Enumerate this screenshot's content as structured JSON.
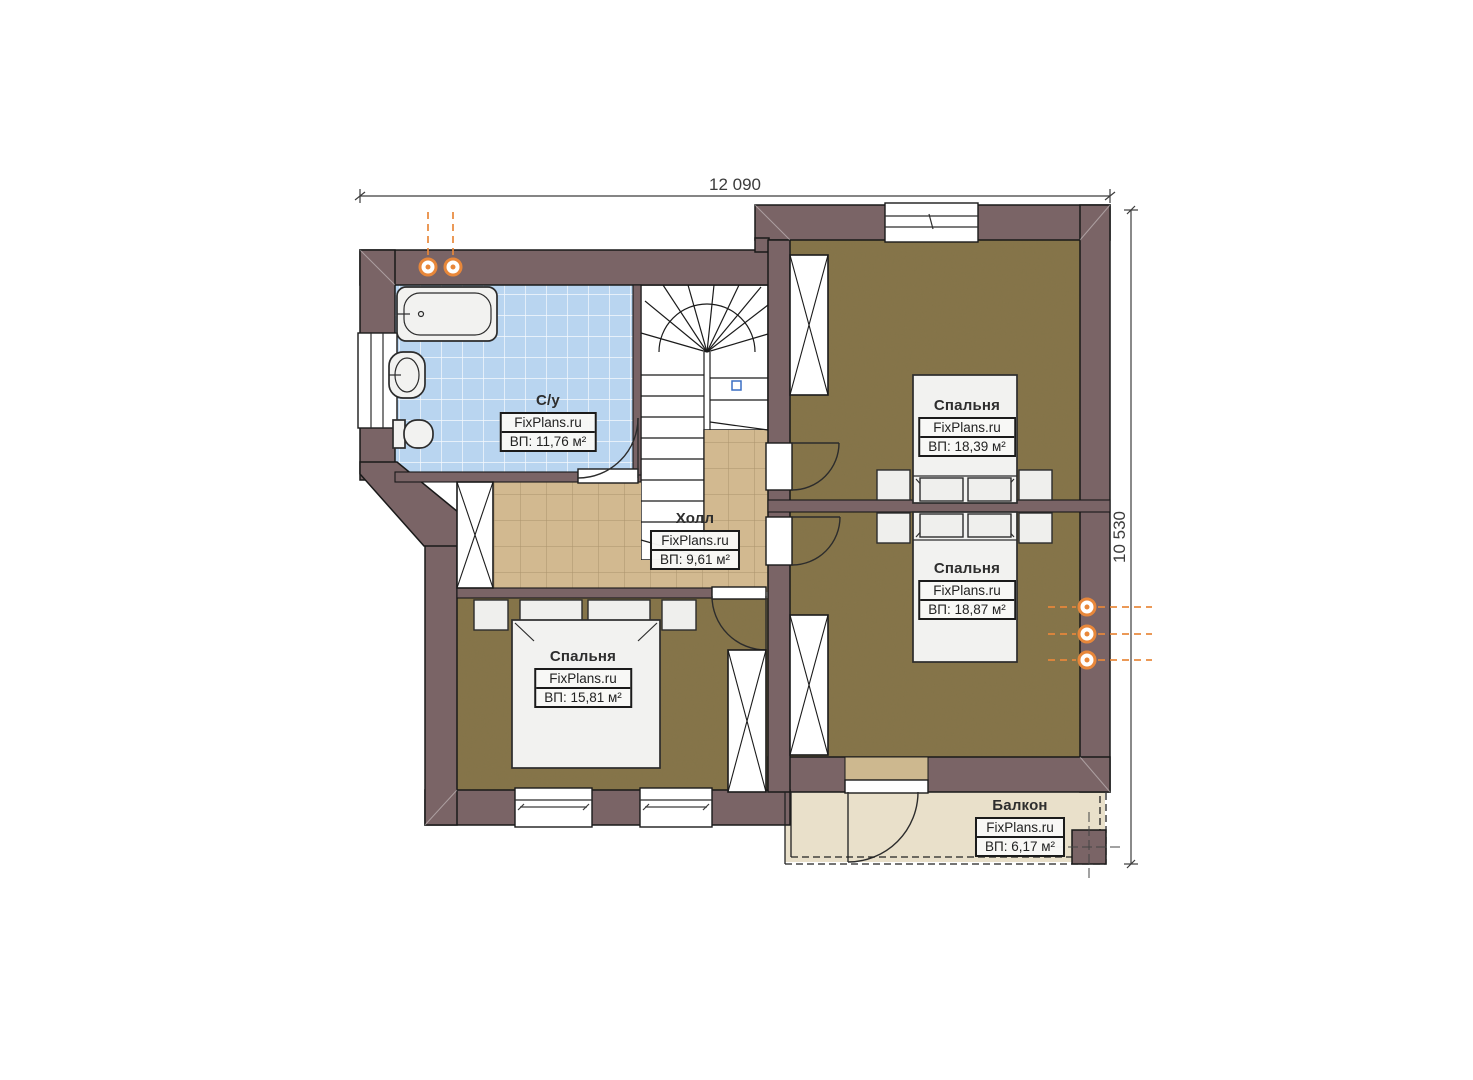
{
  "plan": {
    "dimension_width": "12 090",
    "dimension_height": "10 530",
    "rooms": [
      {
        "id": "bathroom",
        "name": "С/у",
        "brand": "FixPlans.ru",
        "area": "ВП: 11,76 м²"
      },
      {
        "id": "hall",
        "name": "Холл",
        "brand": "FixPlans.ru",
        "area": "ВП: 9,61 м²"
      },
      {
        "id": "bedroom-top-right",
        "name": "Спальня",
        "brand": "FixPlans.ru",
        "area": "ВП: 18,39 м²"
      },
      {
        "id": "bedroom-bottom-right",
        "name": "Спальня",
        "brand": "FixPlans.ru",
        "area": "ВП: 18,87 м²"
      },
      {
        "id": "bedroom-left",
        "name": "Спальня",
        "brand": "FixPlans.ru",
        "area": "ВП: 15,81 м²"
      },
      {
        "id": "balcony",
        "name": "Балкон",
        "brand": "FixPlans.ru",
        "area": "ВП: 6,17 м²"
      }
    ],
    "colors": {
      "wall": "#7a6466",
      "bath_floor": "#b9d5f0",
      "hall_floor": "#d2b990",
      "bedroom_floor": "#857449",
      "balcony_floor": "#e9e0ca",
      "furniture": "#f2f2f0",
      "pipe": "#e8873a",
      "dimension": "#3c3c3c"
    }
  }
}
